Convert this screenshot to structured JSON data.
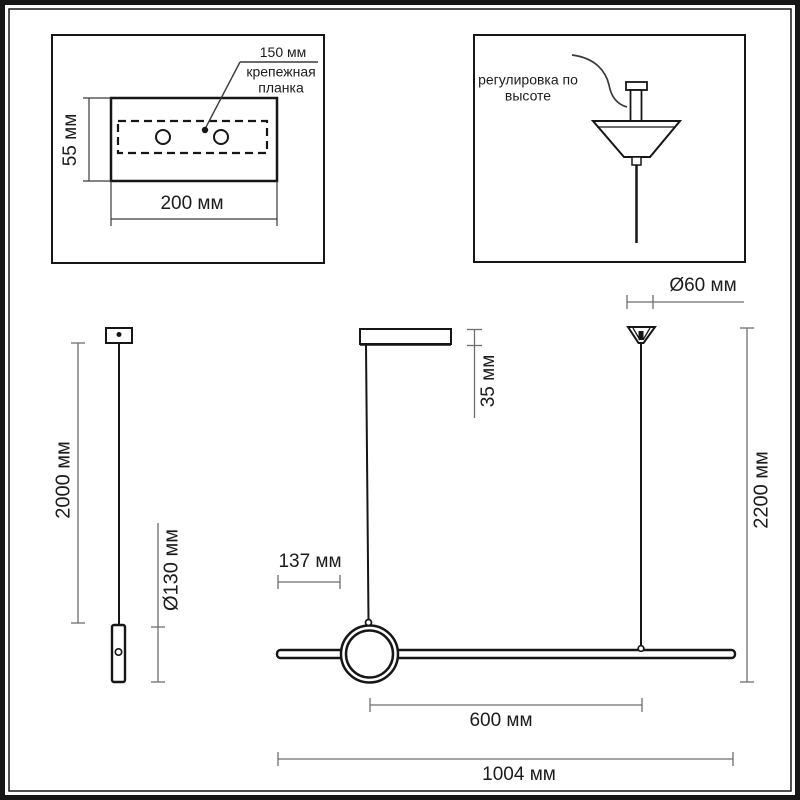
{
  "panel_mounting": {
    "dim_bracket_length": "150 мм",
    "plate_label": "крепежная планка",
    "dim_plate_height": "55 мм",
    "dim_plate_width": "200 мм"
  },
  "panel_adjustment": {
    "label": "регулировка по высоте"
  },
  "side_view": {
    "dim_suspension_height": "2000 мм",
    "dim_diameter": "Ø130 мм"
  },
  "front_view": {
    "dim_canopy_height": "35 мм",
    "dim_ring_offset": "137 мм",
    "dim_bar_span": "600 мм",
    "dim_total_length": "1004 мм"
  },
  "hanger_view": {
    "dim_canopy_diameter": "Ø60 мм",
    "dim_total_height": "2200 мм"
  },
  "colors": {
    "line": "#161616",
    "dim": "#6e6e6e",
    "text": "#1c1c1c",
    "bg": "#ffffff"
  }
}
